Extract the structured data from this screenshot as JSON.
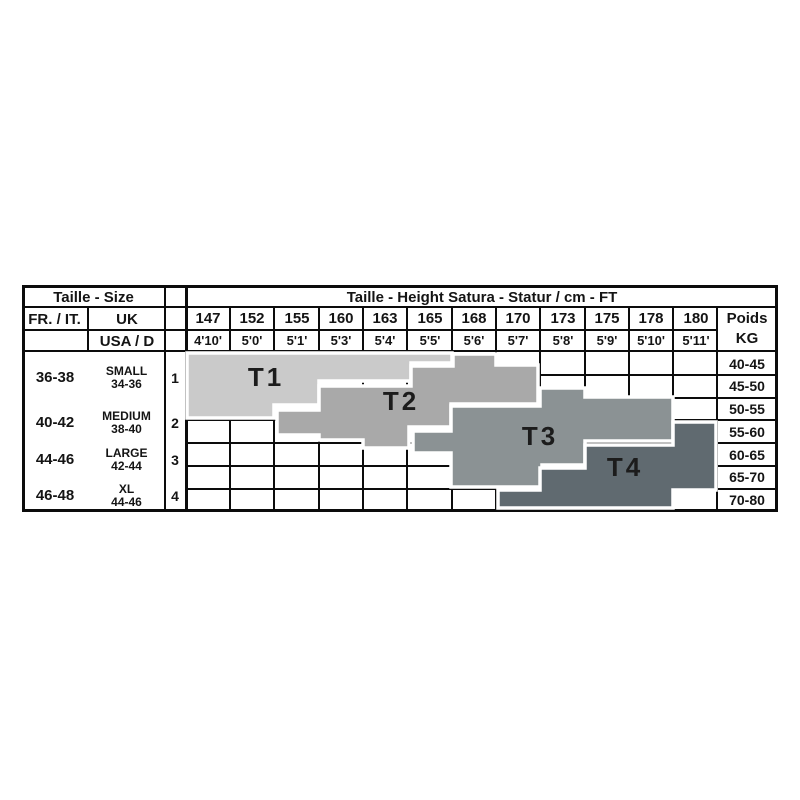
{
  "table": {
    "corner_header": "Taille - Size",
    "main_header": "Taille - Height Satura - Statur / cm - FT",
    "col_headers": {
      "fr_it": "FR. / IT.",
      "uk": "UK",
      "usa_d": "USA / D"
    },
    "weight_header": {
      "line1": "Poids",
      "line2": "KG"
    },
    "heights_cm": [
      "147",
      "152",
      "155",
      "160",
      "163",
      "165",
      "168",
      "170",
      "173",
      "175",
      "178",
      "180"
    ],
    "heights_ft": [
      "4'10'",
      "5'0'",
      "5'1'",
      "5'3'",
      "5'4'",
      "5'5'",
      "5'6'",
      "5'7'",
      "5'8'",
      "5'9'",
      "5'10'",
      "5'11'"
    ],
    "weights_kg": [
      "40-45",
      "45-50",
      "50-55",
      "55-60",
      "60-65",
      "65-70",
      "70-80"
    ],
    "sizes": [
      {
        "fr": "36-38",
        "uk1": "SMALL",
        "uk2": "34-36",
        "num": "1"
      },
      {
        "fr": "40-42",
        "uk1": "MEDIUM",
        "uk2": "38-40",
        "num": "2"
      },
      {
        "fr": "44-46",
        "uk1": "LARGE",
        "uk2": "42-44",
        "num": "3"
      },
      {
        "fr": "46-48",
        "uk1": "XL",
        "uk2": "44-46",
        "num": "4"
      }
    ],
    "bands": [
      {
        "label": "T1",
        "color": "#cacaca"
      },
      {
        "label": "T2",
        "color": "#a9a9a9"
      },
      {
        "label": "T3",
        "color": "#8b9294"
      },
      {
        "label": "T4",
        "color": "#606a70"
      }
    ],
    "line_color": "#0c0c0c",
    "outline_color": "#ffffff"
  },
  "chart_data": {
    "type": "heatmap",
    "title": "Taille - Height Satura - Statur / cm - FT",
    "x_labels_cm": [
      "147",
      "152",
      "155",
      "160",
      "163",
      "165",
      "168",
      "170",
      "173",
      "175",
      "178",
      "180"
    ],
    "x_labels_ft": [
      "4'10'",
      "5'0'",
      "5'1'",
      "5'3'",
      "5'4'",
      "5'5'",
      "5'6'",
      "5'7'",
      "5'8'",
      "5'9'",
      "5'10'",
      "5'11'"
    ],
    "y_labels_kg": [
      "40-45",
      "45-50",
      "50-55",
      "55-60",
      "60-65",
      "65-70",
      "70-80"
    ],
    "legend_position": "left-column",
    "grid": true,
    "series": [
      {
        "name": "T1",
        "fr_it": "36-38",
        "uk": "SMALL 34-36",
        "usa_d": "1",
        "color": "#cacaca",
        "height_range_cm": "147-165",
        "weight_range_kg": "40-55"
      },
      {
        "name": "T2",
        "fr_it": "40-42",
        "uk": "MEDIUM 38-40",
        "usa_d": "2",
        "color": "#a9a9a9",
        "height_range_cm": "155-170",
        "weight_range_kg": "40-60"
      },
      {
        "name": "T3",
        "fr_it": "44-46",
        "uk": "LARGE 42-44",
        "usa_d": "3",
        "color": "#8b9294",
        "height_range_cm": "163-178",
        "weight_range_kg": "45-70"
      },
      {
        "name": "T4",
        "fr_it": "46-48",
        "uk": "XL 44-46",
        "usa_d": "4",
        "color": "#606a70",
        "height_range_cm": "168-180",
        "weight_range_kg": "55-80"
      }
    ]
  }
}
